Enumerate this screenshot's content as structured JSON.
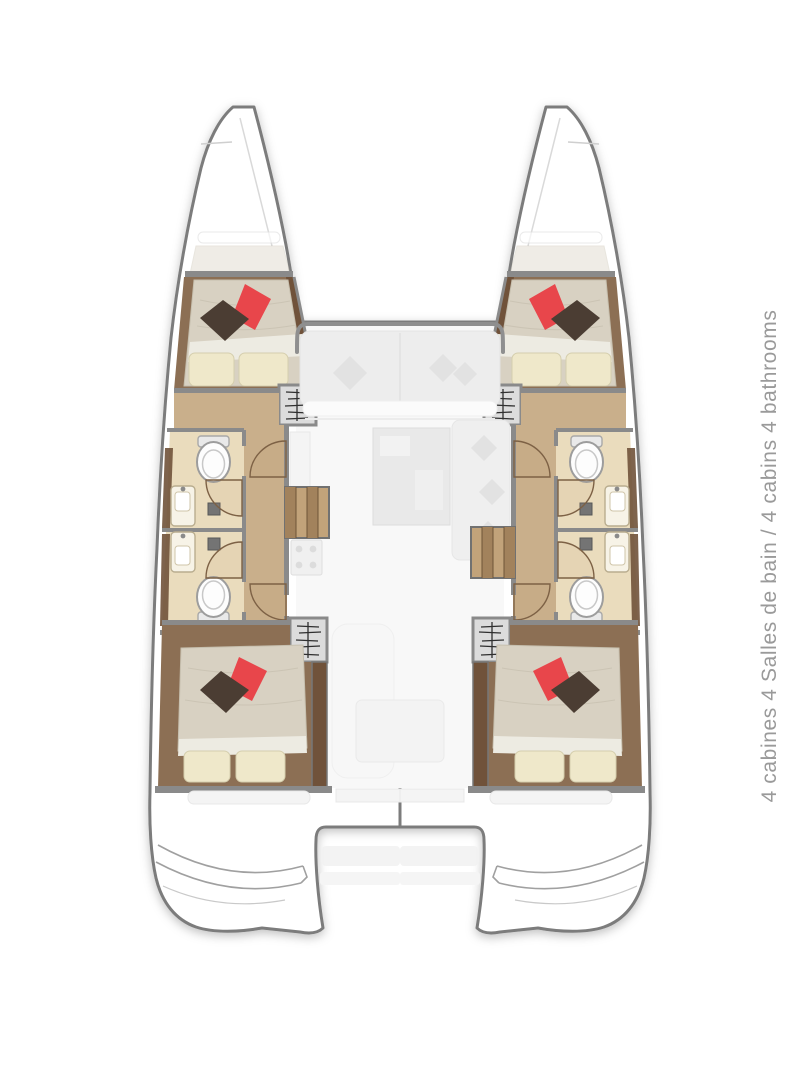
{
  "window": {
    "width": 810,
    "height": 1080,
    "background": "#ffffff"
  },
  "label": {
    "text": "4 cabines 4 Salles de bain / 4 cabins 4 bathrooms",
    "orientation": "vertical-bottom-to-top",
    "color": "#9a9a9a"
  },
  "plan": {
    "type": "catamaran-deck-plan-top-view",
    "hulls": [
      "port",
      "starboard"
    ],
    "features": [
      "bow-anchor-locker",
      "forward-cabin-double-bed",
      "aft-cabin-double-bed",
      "forward-bathroom",
      "aft-bathroom",
      "toilet-symbol",
      "sink-symbol",
      "shower-drain",
      "door-swing-arc",
      "companionway-steps-hatch",
      "hull-stairs",
      "saloon-ghost-furniture",
      "cockpit-ghost-furniture",
      "swim-platform-steps",
      "stern-tender-recess"
    ]
  },
  "colors": {
    "outline": "#7c7c7c",
    "wall": "#8a8a8a",
    "wood": "#8c6f54",
    "woodDark": "#70523a",
    "corridor": "#c9af8b",
    "bath": "#eadcbd",
    "mattress": "#d8d1c2",
    "sheet": "#edebe2",
    "pillowCream": "#efe8ca",
    "red": "#e8464b",
    "pillowBrown": "#4b3d33",
    "fixture": "#fdfdfd",
    "ghost": "#ededed",
    "stairLight": "#c2a37a",
    "stairDark": "#a2825c",
    "labelText": "#9a9a9a"
  }
}
